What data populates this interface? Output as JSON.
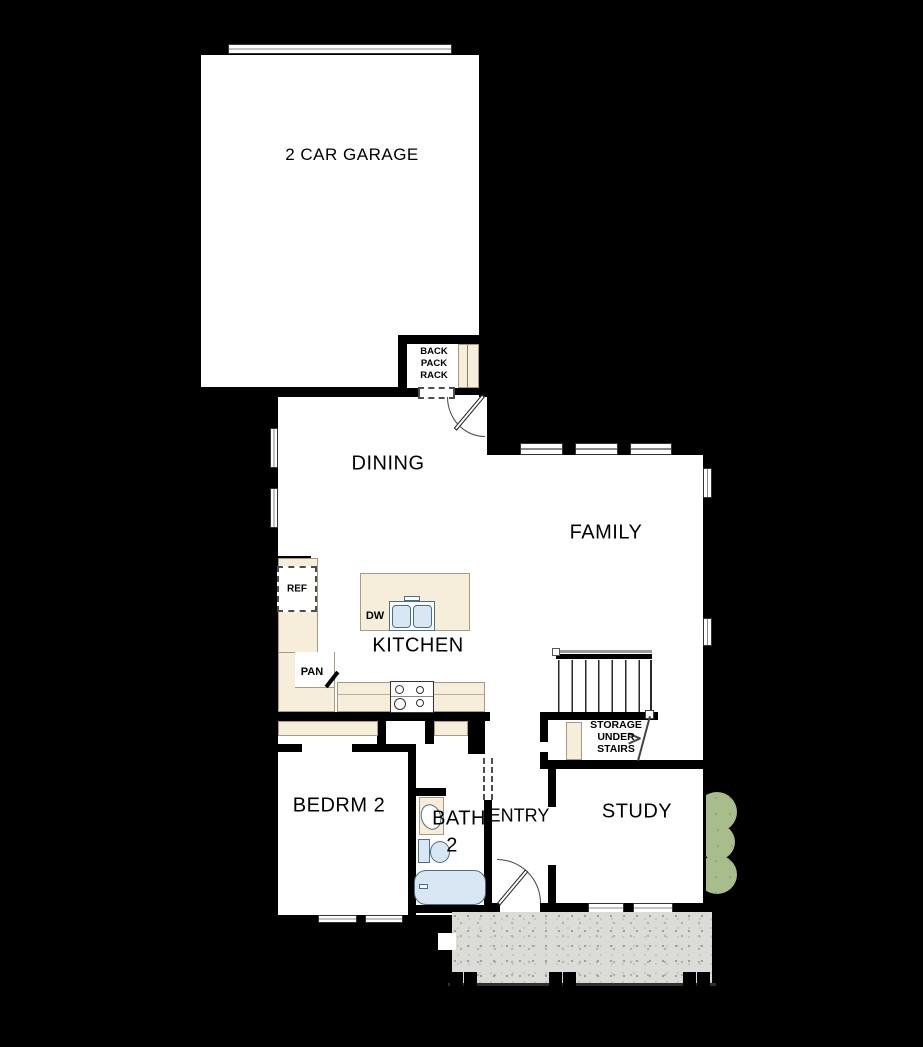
{
  "floorplan": {
    "rooms": {
      "garage": "2 CAR GARAGE",
      "dining": "DINING",
      "family": "FAMILY",
      "kitchen": "KITCHEN",
      "bedroom2": "BEDRM 2",
      "bath2": "BATH",
      "bath2_number": "2",
      "entry": "ENTRY",
      "study": "STUDY"
    },
    "features": {
      "backpack_rack": {
        "line1": "BACK",
        "line2": "PACK",
        "line3": "RACK"
      },
      "storage_under_stairs": {
        "line1": "STORAGE",
        "line2": "UNDER",
        "line3": "STAIRS"
      },
      "refrigerator": "REF",
      "dishwasher": "DW",
      "pantry": "PAN"
    },
    "colors": {
      "background": "#000000",
      "wall": "#000000",
      "floor": "#ffffff",
      "cabinet_cream": "#f6eeda",
      "fixture_blue": "#d9e7f4",
      "porch_concrete": "#dbdbd7",
      "shrub_green": "#a9bc8c"
    }
  }
}
